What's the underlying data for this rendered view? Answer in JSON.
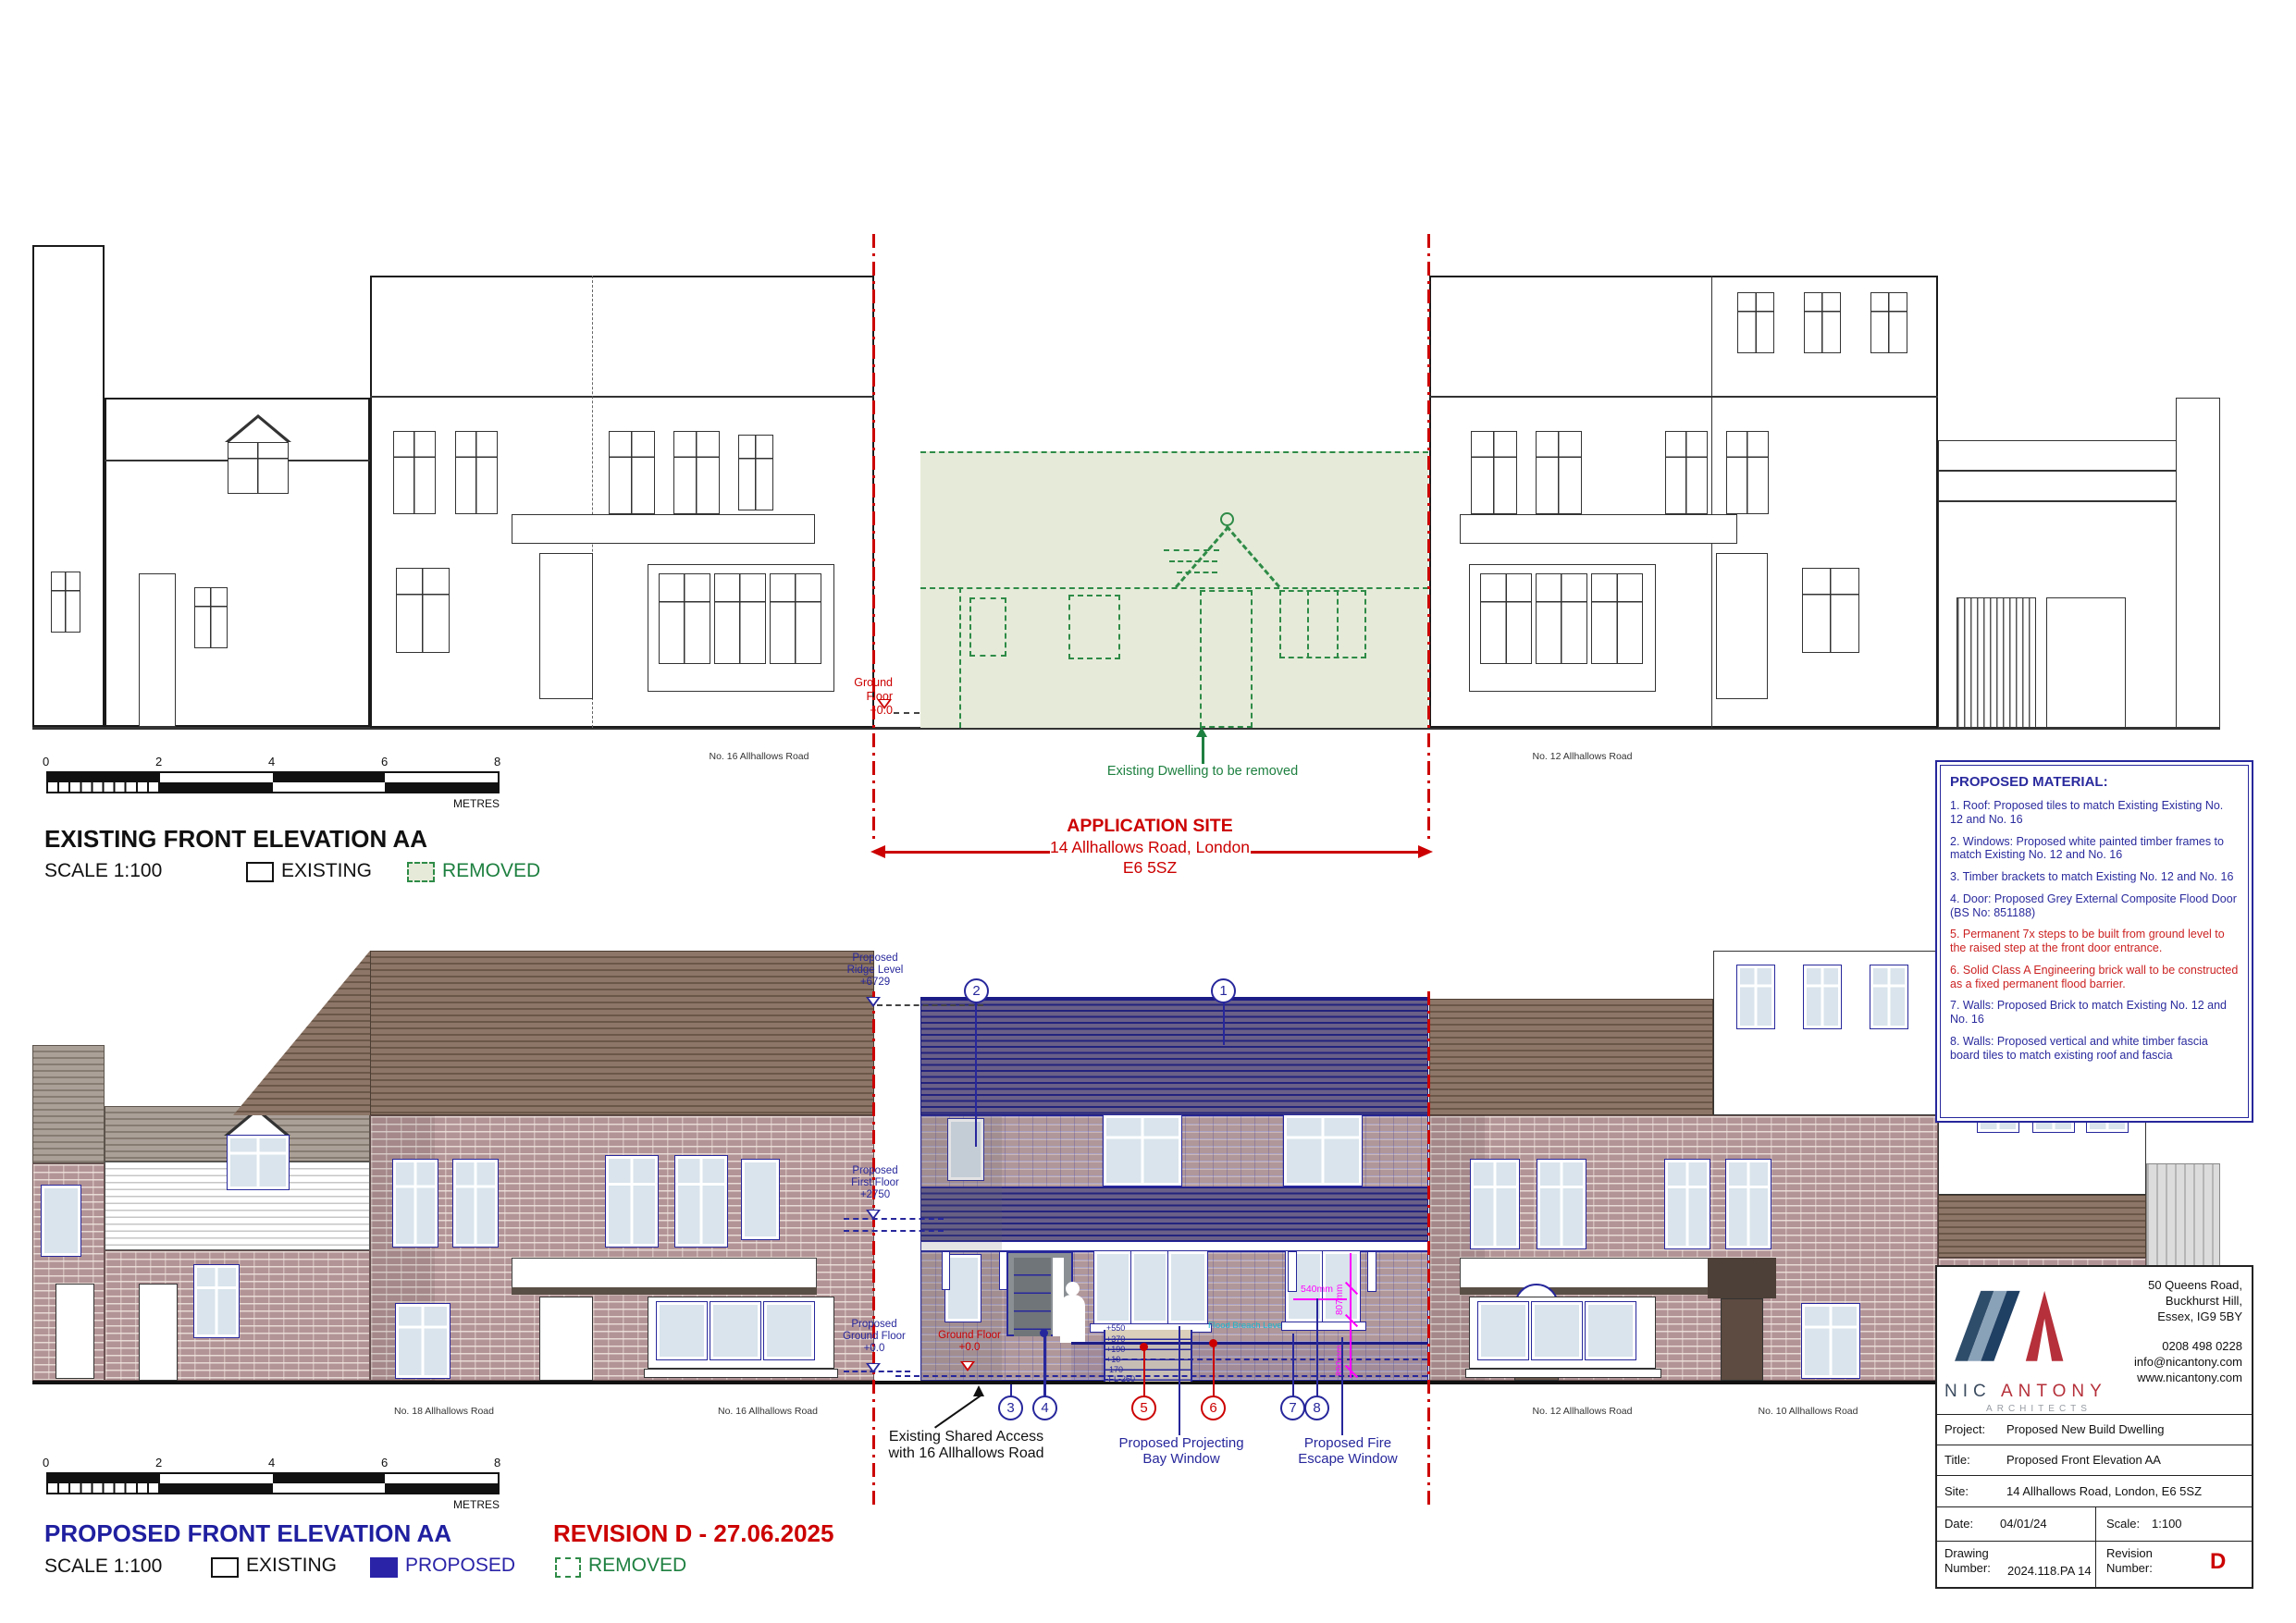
{
  "colors": {
    "red": "#cc0000",
    "green": "#2e8b47",
    "navy": "#27279c",
    "magenta": "#ff00ff",
    "cyan": "#16b8cc",
    "removed_fill": "#e6ebd9",
    "proposed_legend": "#2a23a8"
  },
  "existing": {
    "title": "EXISTING FRONT ELEVATION AA",
    "scale_label": "SCALE 1:100",
    "legend_existing": "EXISTING",
    "legend_removed": "REMOVED",
    "scalebar_ticks": [
      "0",
      "2",
      "4",
      "6",
      "8"
    ],
    "scalebar_unit": "METRES",
    "label_no16": "No. 16 Allhallows Road",
    "label_no12": "No. 12 Allhallows Road",
    "ground_floor_label": "Ground Floor\n+0.0",
    "removed_note": "Existing Dwelling to be removed",
    "site_title": "APPLICATION SITE",
    "site_line2": "14 Allhallows Road, London",
    "site_line3": "E6 5SZ"
  },
  "proposed": {
    "title": "PROPOSED FRONT ELEVATION AA",
    "revision_note": "REVISION D - 27.06.2025",
    "scale_label": "SCALE 1:100",
    "legend_existing": "EXISTING",
    "legend_proposed": "PROPOSED",
    "legend_removed": "REMOVED",
    "scalebar_ticks": [
      "0",
      "2",
      "4",
      "6",
      "8"
    ],
    "scalebar_unit": "METRES",
    "ridge_level": "Proposed\nRidge Level\n+6729",
    "first_floor_level": "Proposed\nFirst Floor\n+2750",
    "ground_floor_level": "Proposed\nGround Floor\n+0.0",
    "ground_floor_red": "Ground Floor\n+0.0",
    "step_levels": [
      "+550",
      "+370",
      "+190",
      "+10",
      "-170",
      "FFL-260"
    ],
    "flood_level_label": "Flood Breach Level",
    "dim_540": "540mm",
    "dim_807": "807mm",
    "dim_890": "890mm",
    "markers": [
      "1",
      "2",
      "3",
      "4",
      "5",
      "6",
      "7",
      "8"
    ],
    "shared_access_label": "Existing Shared Access\nwith 16 Allhallows Road",
    "bay_window_label": "Proposed Projecting\nBay Window",
    "fire_escape_label": "Proposed Fire\nEscape Window",
    "label_no18": "No. 18 Allhallows Road",
    "label_no16": "No. 16 Allhallows Road",
    "label_no12": "No. 12 Allhallows Road",
    "label_no10": "No. 10 Allhallows Road"
  },
  "notes": {
    "title": "PROPOSED MATERIAL:",
    "items": [
      "1. Roof: Proposed tiles to match Existing Existing No. 12 and No. 16",
      "2. Windows: Proposed white painted timber frames to match Existing No. 12 and No. 16",
      "3. Timber brackets to match Existing No. 12 and No. 16",
      "4. Door: Proposed Grey External Composite Flood Door (BS No: 851188)",
      "5. Permanent 7x steps to be built from ground level to the raised step at the front door entrance.",
      "6. Solid Class A Engineering brick wall to be constructed as a fixed permanent flood barrier.",
      "7. Walls: Proposed Brick to match Existing No. 12 and No. 16",
      "8. Walls: Proposed vertical and white timber fascia board tiles to match existing roof and fascia"
    ]
  },
  "titleblock": {
    "logo_nic": "NIC",
    "logo_antony": "ANTONY",
    "logo_sub": "ARCHITECTS",
    "address": "50 Queens Road,\nBuckhurst Hill,\nEssex, IG9 5BY",
    "contact": "0208 498 0228\ninfo@nicantony.com\nwww.nicantony.com",
    "project_label": "Project:",
    "project": "Proposed New Build Dwelling",
    "title_label": "Title:",
    "title": "Proposed Front Elevation AA",
    "site_label": "Site:",
    "site": "14 Allhallows Road, London, E6 5SZ",
    "date_label": "Date:",
    "date": "04/01/24",
    "scale_label": "Scale:",
    "scale": "1:100",
    "drawing_label": "Drawing\nNumber:",
    "drawing": "2024.118.PA 14",
    "revision_label": "Revision\nNumber:",
    "revision": "D"
  }
}
